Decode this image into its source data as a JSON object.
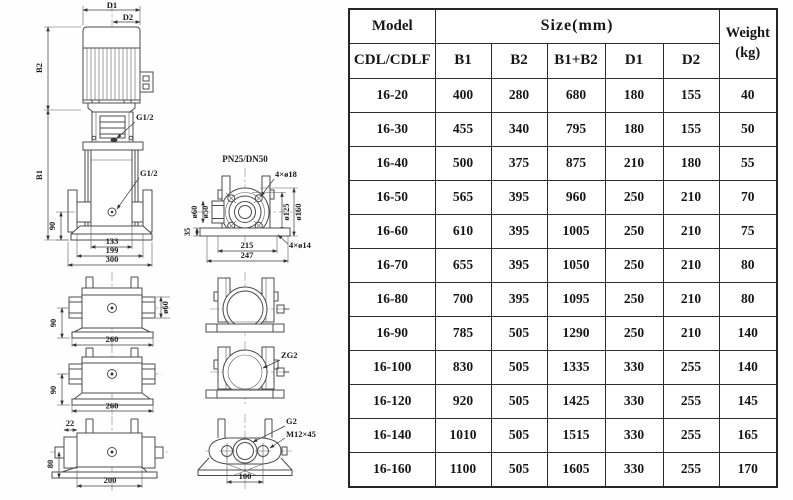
{
  "drawing": {
    "front": {
      "d1": "D1",
      "d2": "D2",
      "b1": "B1",
      "b2": "B2",
      "g_top": "G1/2",
      "g_mid": "G1/2",
      "dim_90": "90",
      "dim_133": "133",
      "dim_199": "199",
      "dim_300": "300"
    },
    "flange": {
      "title": "PN25/DN50",
      "holes_top": "4×ø18",
      "holes_bottom": "4×ø14",
      "dia_bolt_circle": "ø125",
      "dia_outer": "ø160",
      "dia_port_outer": "ø60",
      "dia_port_inner": "ø50",
      "dim_35": "35",
      "dim_215": "215",
      "dim_247": "247"
    },
    "section_a": {
      "dim_90": "90",
      "dim_260": "260",
      "dia_60": "ø60"
    },
    "section_b": {
      "dim_90": "90",
      "dim_260": "260"
    },
    "section_c": {
      "dim_22": "22",
      "dim_80": "80",
      "dim_200": "200"
    },
    "port_b": {
      "thread": "ZG2"
    },
    "port_c": {
      "thread": "G2",
      "bolt": "M12×45",
      "dim_100": "100"
    }
  },
  "table": {
    "header": {
      "model": "Model",
      "model_sub": "CDL/CDLF",
      "size_group": "Size(mm)",
      "size_cols": [
        "B1",
        "B2",
        "B1+B2",
        "D1",
        "D2"
      ],
      "weight_top": "Weight",
      "weight_bottom": "(kg)"
    },
    "rows": [
      {
        "model": "16-20",
        "values": [
          "400",
          "280",
          "680",
          "180",
          "155",
          "40"
        ]
      },
      {
        "model": "16-30",
        "values": [
          "455",
          "340",
          "795",
          "180",
          "155",
          "50"
        ]
      },
      {
        "model": "16-40",
        "values": [
          "500",
          "375",
          "875",
          "210",
          "180",
          "55"
        ]
      },
      {
        "model": "16-50",
        "values": [
          "565",
          "395",
          "960",
          "250",
          "210",
          "70"
        ]
      },
      {
        "model": "16-60",
        "values": [
          "610",
          "395",
          "1005",
          "250",
          "210",
          "75"
        ]
      },
      {
        "model": "16-70",
        "values": [
          "655",
          "395",
          "1050",
          "250",
          "210",
          "80"
        ]
      },
      {
        "model": "16-80",
        "values": [
          "700",
          "395",
          "1095",
          "250",
          "210",
          "80"
        ]
      },
      {
        "model": "16-90",
        "values": [
          "785",
          "505",
          "1290",
          "250",
          "210",
          "140"
        ]
      },
      {
        "model": "16-100",
        "values": [
          "830",
          "505",
          "1335",
          "330",
          "255",
          "140"
        ]
      },
      {
        "model": "16-120",
        "values": [
          "920",
          "505",
          "1425",
          "330",
          "255",
          "145"
        ]
      },
      {
        "model": "16-140",
        "values": [
          "1010",
          "505",
          "1515",
          "330",
          "255",
          "165"
        ]
      },
      {
        "model": "16-160",
        "values": [
          "1100",
          "505",
          "1605",
          "330",
          "255",
          "170"
        ]
      }
    ]
  }
}
